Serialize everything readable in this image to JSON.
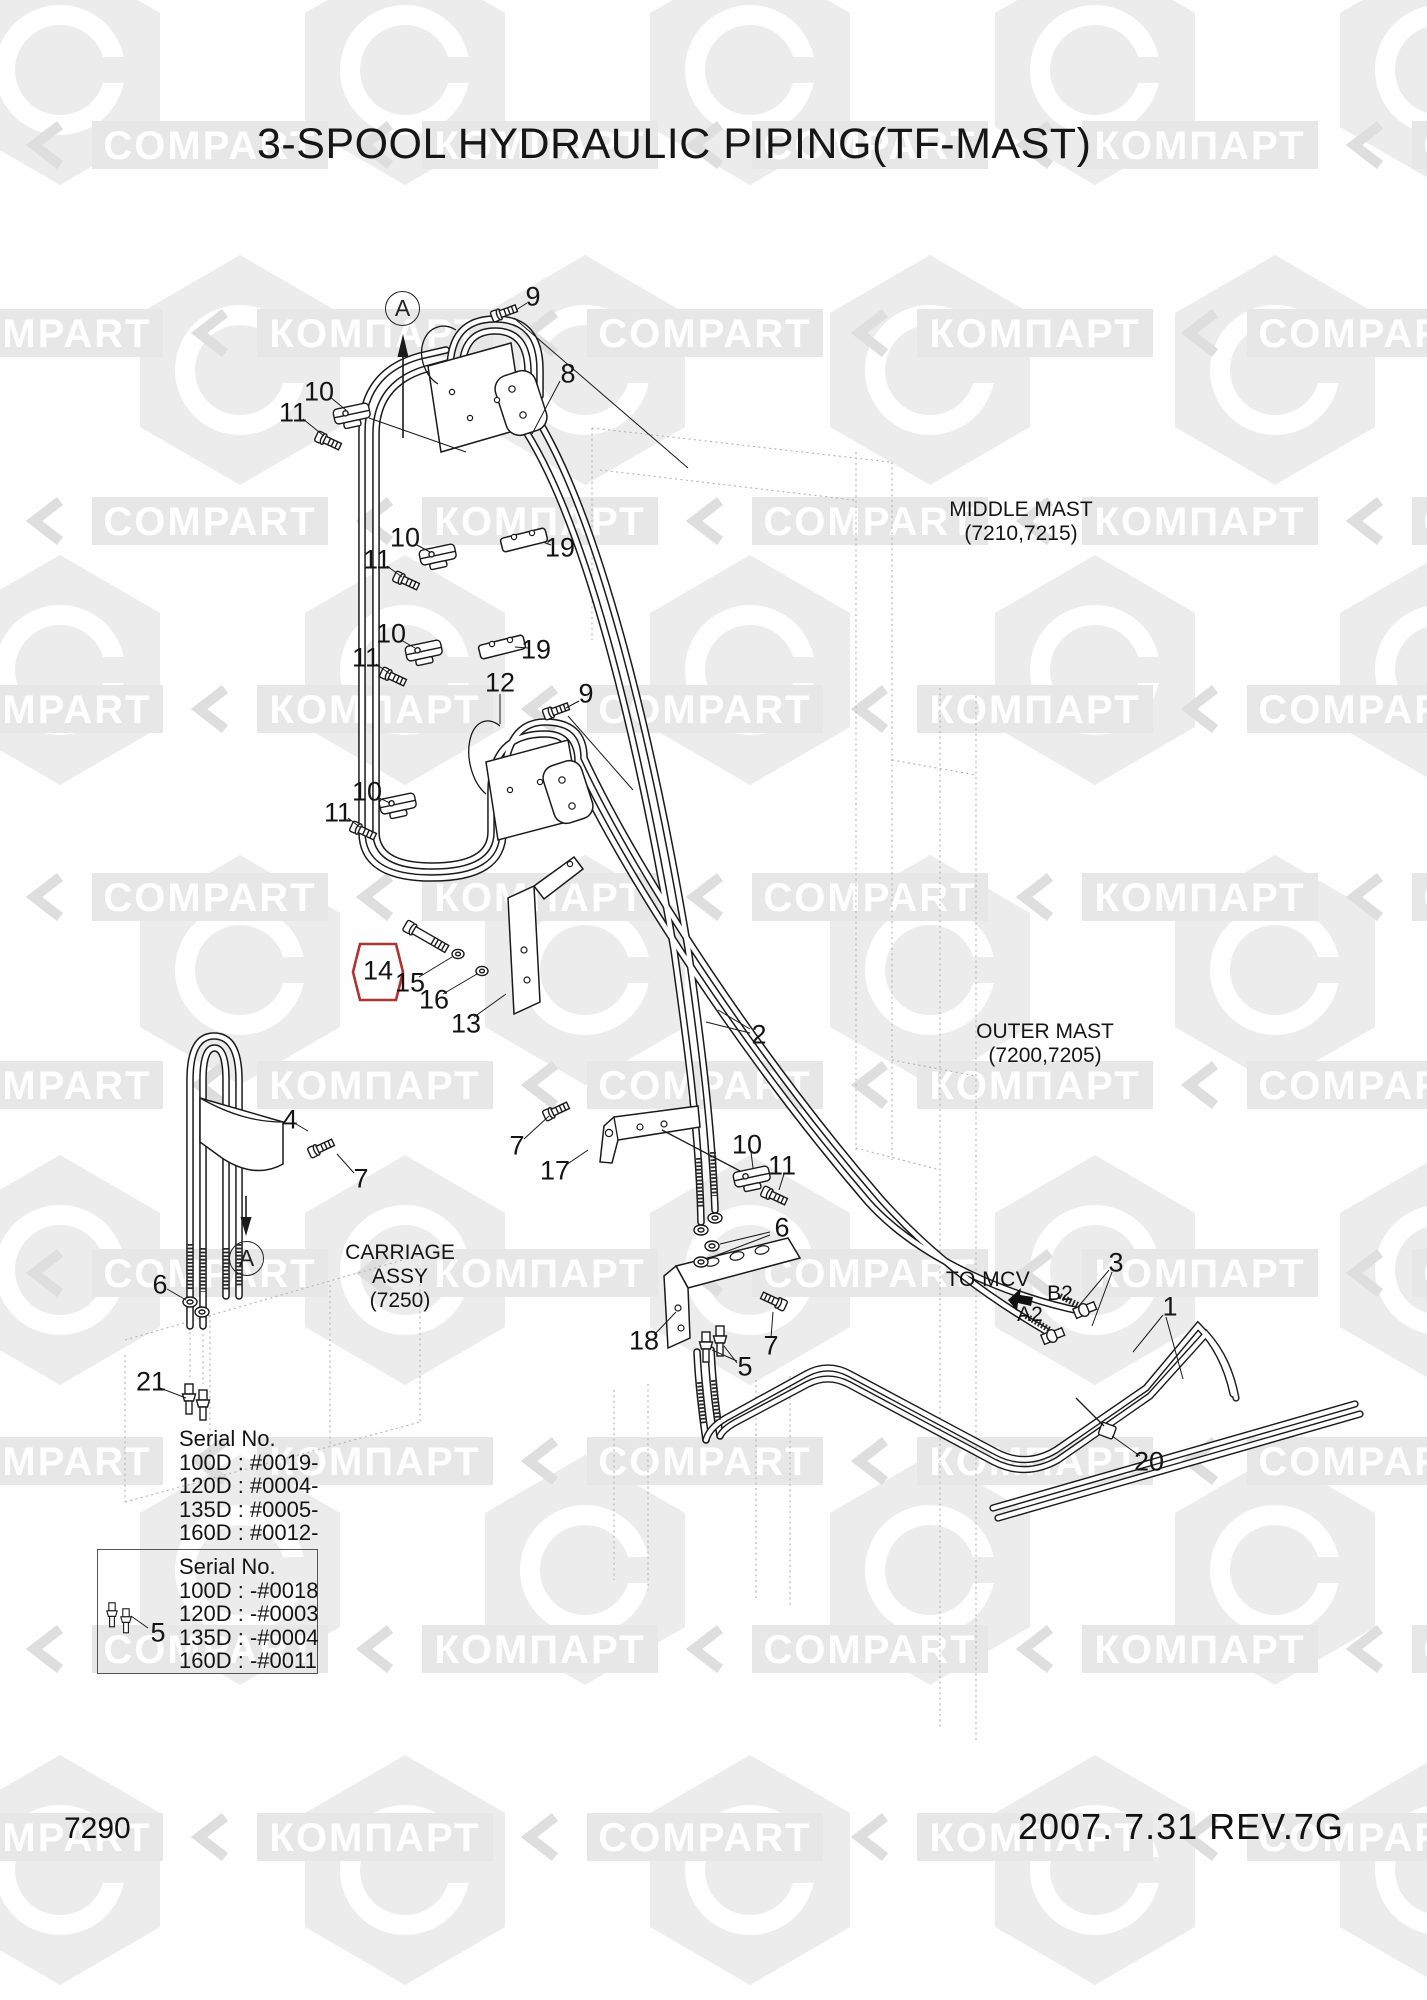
{
  "title": "3-SPOOL HYDRAULIC PIPING(TF-MAST)",
  "watermark": {
    "words": [
      "КОМПАРТ",
      "COMPART"
    ]
  },
  "view_marker": "A",
  "area_labels": {
    "middle_mast": {
      "name": "MIDDLE MAST",
      "code": "(7210,7215)"
    },
    "outer_mast": {
      "name": "OUTER MAST",
      "code": "(7200,7205)"
    },
    "carriage": {
      "name": "CARRIAGE ASSY",
      "code": "(7250)"
    },
    "to_mcv": "TO MCV",
    "port_b2": "B2",
    "port_a2": "A2"
  },
  "callouts": [
    {
      "n": "9",
      "x": 533,
      "y": 297
    },
    {
      "n": "8",
      "x": 568,
      "y": 374
    },
    {
      "n": "10",
      "x": 319,
      "y": 392
    },
    {
      "n": "11",
      "x": 293,
      "y": 413
    },
    {
      "n": "19",
      "x": 560,
      "y": 548
    },
    {
      "n": "10",
      "x": 405,
      "y": 538
    },
    {
      "n": "11",
      "x": 377,
      "y": 560
    },
    {
      "n": "12",
      "x": 500,
      "y": 683
    },
    {
      "n": "9",
      "x": 586,
      "y": 694
    },
    {
      "n": "19",
      "x": 536,
      "y": 650
    },
    {
      "n": "10",
      "x": 391,
      "y": 634
    },
    {
      "n": "11",
      "x": 366,
      "y": 658
    },
    {
      "n": "10",
      "x": 367,
      "y": 792
    },
    {
      "n": "11",
      "x": 338,
      "y": 813
    },
    {
      "n": "14",
      "x": 378,
      "y": 971,
      "highlight": true
    },
    {
      "n": "15",
      "x": 410,
      "y": 983
    },
    {
      "n": "16",
      "x": 434,
      "y": 1000
    },
    {
      "n": "13",
      "x": 466,
      "y": 1024
    },
    {
      "n": "2",
      "x": 759,
      "y": 1035
    },
    {
      "n": "4",
      "x": 290,
      "y": 1120
    },
    {
      "n": "7",
      "x": 361,
      "y": 1179
    },
    {
      "n": "7",
      "x": 517,
      "y": 1146
    },
    {
      "n": "17",
      "x": 555,
      "y": 1171
    },
    {
      "n": "10",
      "x": 747,
      "y": 1145
    },
    {
      "n": "11",
      "x": 782,
      "y": 1166
    },
    {
      "n": "6",
      "x": 160,
      "y": 1285
    },
    {
      "n": "6",
      "x": 782,
      "y": 1228
    },
    {
      "n": "18",
      "x": 644,
      "y": 1341
    },
    {
      "n": "7",
      "x": 771,
      "y": 1346
    },
    {
      "n": "5",
      "x": 745,
      "y": 1367
    },
    {
      "n": "21",
      "x": 151,
      "y": 1382
    },
    {
      "n": "3",
      "x": 1116,
      "y": 1263
    },
    {
      "n": "1",
      "x": 1170,
      "y": 1307
    },
    {
      "n": "20",
      "x": 1149,
      "y": 1462
    },
    {
      "n": "5",
      "x": 158,
      "y": 1633
    }
  ],
  "serial_block_top": {
    "heading": "Serial No.",
    "rows": [
      "100D : #0019-",
      "120D : #0004-",
      "135D : #0005-",
      "160D : #0012-"
    ]
  },
  "serial_block_boxed": {
    "heading": "Serial No.",
    "rows": [
      "100D : -#0018",
      "120D : -#0003",
      "135D : -#0004",
      "160D : -#0011"
    ]
  },
  "footer": {
    "page_number": "7290",
    "revision": "2007. 7.31 REV.7G"
  },
  "colors": {
    "highlight": "#b03232",
    "line": "#1a1a1a",
    "watermark": "#ececec"
  }
}
